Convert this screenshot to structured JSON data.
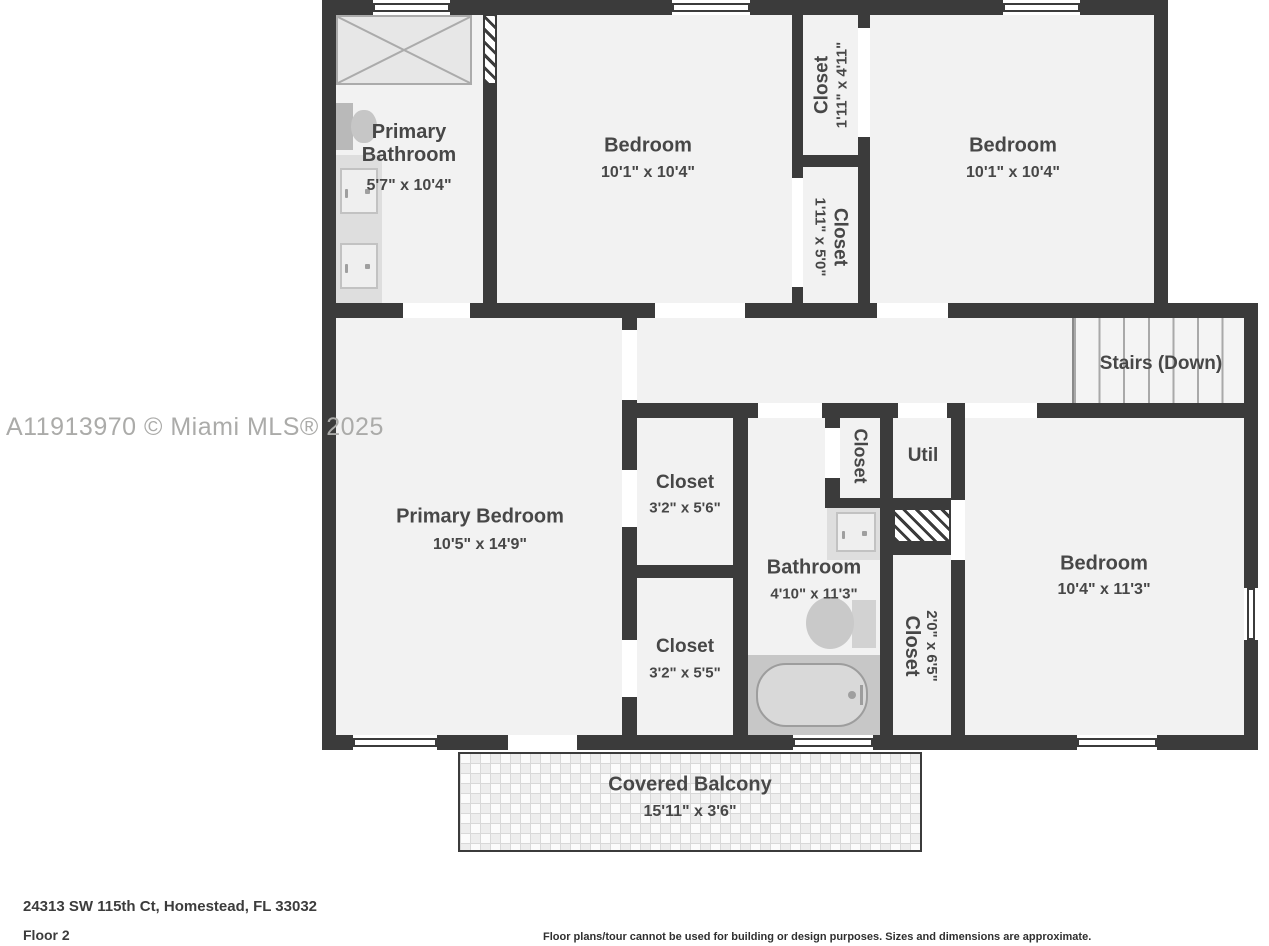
{
  "watermark": "A11913970 © Miami MLS® 2025",
  "footer": {
    "address": "24313 SW 115th Ct, Homestead, FL 33032",
    "floor": "Floor 2",
    "disclaimer": "Floor plans/tour cannot be used for building or design purposes. Sizes and dimensions are approximate."
  },
  "colors": {
    "wall": "#3b3b3b",
    "room_fill": "#f2f2f2",
    "label_text": "#474747",
    "watermark_text": "#ababa9"
  },
  "rooms": {
    "primary_bathroom": {
      "name": "Primary Bathroom",
      "dims": "5'7\" x 10'4\""
    },
    "bedroom_top_middle": {
      "name": "Bedroom",
      "dims": "10'1\" x 10'4\""
    },
    "closet_top_a": {
      "name": "Closet",
      "dims": "1'11\" x 4'11\""
    },
    "closet_top_b": {
      "name": "Closet",
      "dims": "1'11\" x 5'0\""
    },
    "bedroom_top_right": {
      "name": "Bedroom",
      "dims": "10'1\" x 10'4\""
    },
    "stairs": {
      "name": "Stairs (Down)"
    },
    "primary_bedroom": {
      "name": "Primary Bedroom",
      "dims": "10'5\" x 14'9\""
    },
    "closet_upper": {
      "name": "Closet",
      "dims": "3'2\" x 5'6\""
    },
    "closet_lower": {
      "name": "Closet",
      "dims": "3'2\" x 5'5\""
    },
    "bathroom": {
      "name": "Bathroom",
      "dims": "4'10\" x 11'3\""
    },
    "closet_bath": {
      "name": "Closet"
    },
    "util": {
      "name": "Util"
    },
    "closet_hall": {
      "name": "Closet",
      "dims": "2'0\" x 6'5\""
    },
    "bedroom_bottom_right": {
      "name": "Bedroom",
      "dims": "10'4\" x 11'3\""
    },
    "covered_balcony": {
      "name": "Covered Balcony",
      "dims": "15'11\" x 3'6\""
    }
  }
}
